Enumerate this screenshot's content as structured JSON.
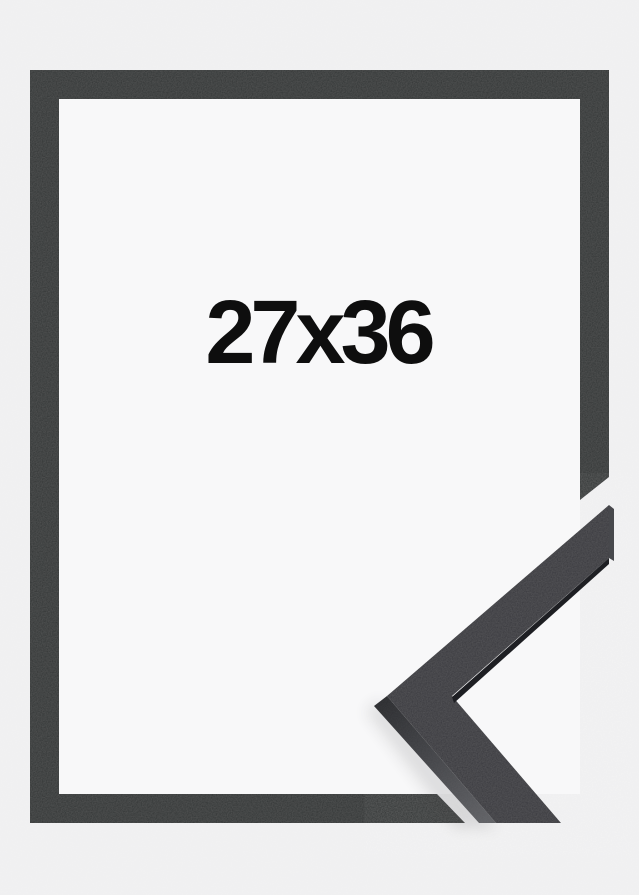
{
  "product": {
    "size_label": "27x36"
  },
  "colors": {
    "background": "#f0f0f1",
    "mat": "#f8f8f9",
    "frame": "#2f3033",
    "chevron_face": "#35363a",
    "chevron_side_dark": "#2a2b2e",
    "chevron_side_light": "#5d5e62",
    "chevron_edge_dark": "#1e1f23",
    "chevron_end_face": "#47484c",
    "label_color": "#0e0e0e",
    "shadow": "#3a3b3e"
  }
}
